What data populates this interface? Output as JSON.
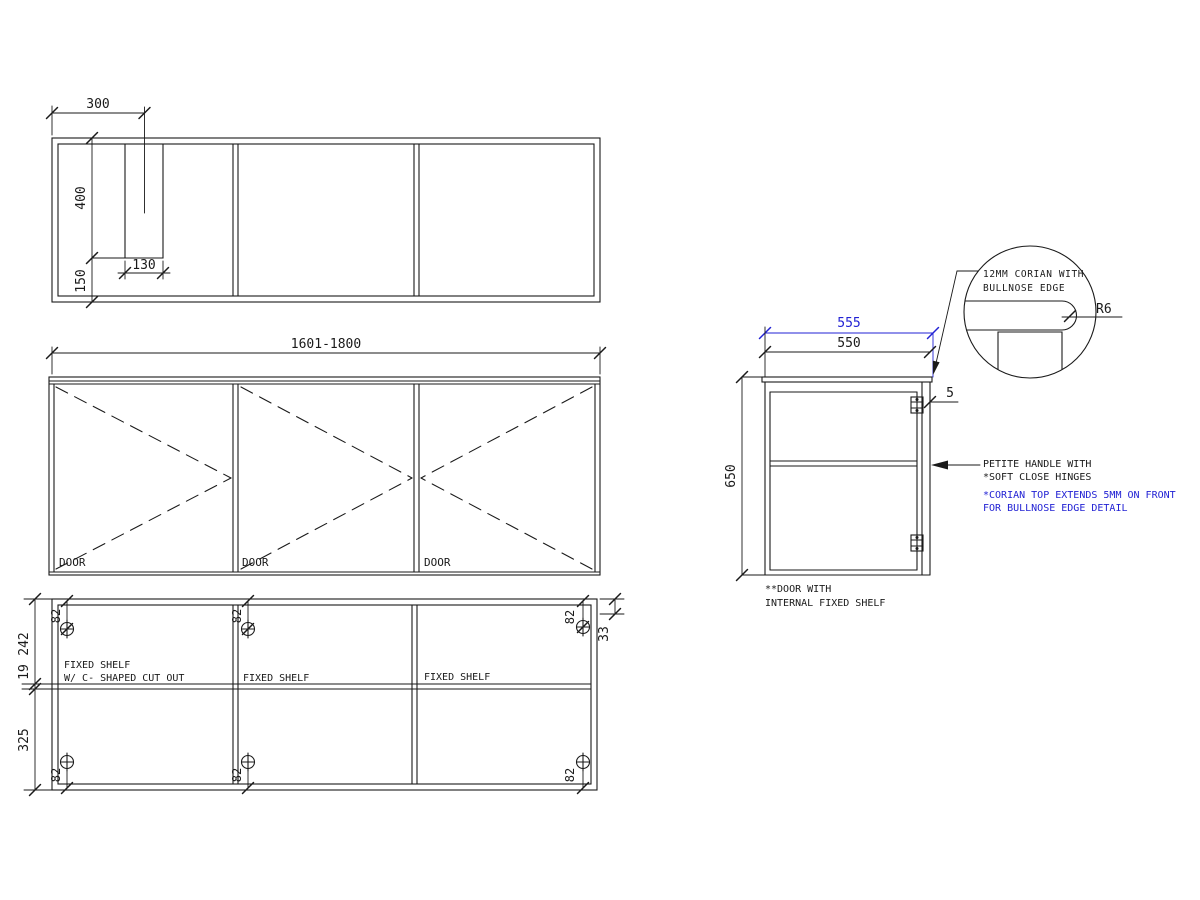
{
  "top_plan": {
    "dim_offset": "300",
    "dim_cutout_depth": "400",
    "dim_back_margin": "150",
    "dim_cutout_width": "130"
  },
  "front_elevation": {
    "dim_width_range": "1601-1800",
    "door_1": "DOOR",
    "door_2": "DOOR",
    "door_3": "DOOR"
  },
  "internal_elevation": {
    "dim_top": "242",
    "dim_shelf_thickness": "19",
    "dim_bottom": "325",
    "dim_right": "33",
    "hinge_offset": "82",
    "shelf_1_line1": "FIXED SHELF",
    "shelf_1_line2": "W/ C- SHAPED CUT OUT",
    "shelf_2": "FIXED SHELF",
    "shelf_3": "FIXED SHELF"
  },
  "side_section": {
    "dim_corian_depth": "555",
    "dim_carcass_depth": "550",
    "dim_height": "650",
    "dim_overhang": "5",
    "note_handle_1": "PETITE HANDLE WITH",
    "note_handle_2": "*SOFT CLOSE HINGES",
    "note_corian_1": "*CORIAN TOP EXTENDS 5MM ON FRONT",
    "note_corian_2": "FOR BULLNOSE EDGE DETAIL",
    "note_door_1": "**DOOR WITH",
    "note_door_2": "INTERNAL FIXED SHELF"
  },
  "detail": {
    "callout_1": "12MM CORIAN WITH",
    "callout_2": "BULLNOSE EDGE",
    "radius": "R6"
  },
  "colors": {
    "line": "#1a1a1a",
    "accent": "#2222d4",
    "background": "#ffffff"
  }
}
